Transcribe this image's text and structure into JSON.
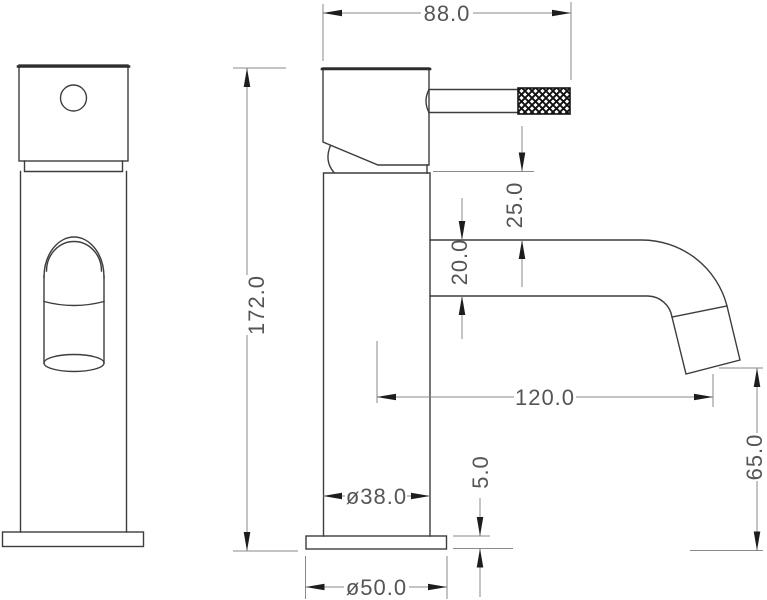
{
  "drawing": {
    "kind": "technical-dimension-drawing",
    "views": [
      "front-view",
      "side-view"
    ]
  },
  "dimensions": {
    "head_width": "88.0",
    "overall_height": "172.0",
    "body_top_to_spout": "25.0",
    "spout_tube_diameter": "20.0",
    "spout_reach": "120.0",
    "body_diameter": "ø38.0",
    "base_thickness": "5.0",
    "spout_outlet_height": "65.0",
    "base_diameter": "ø50.0"
  },
  "colors": {
    "background": "#ffffff",
    "outline": "#3d3d3d",
    "dimension_line": "#8a8a8a",
    "arrow": "#1d1d1d",
    "text": "#555555"
  }
}
